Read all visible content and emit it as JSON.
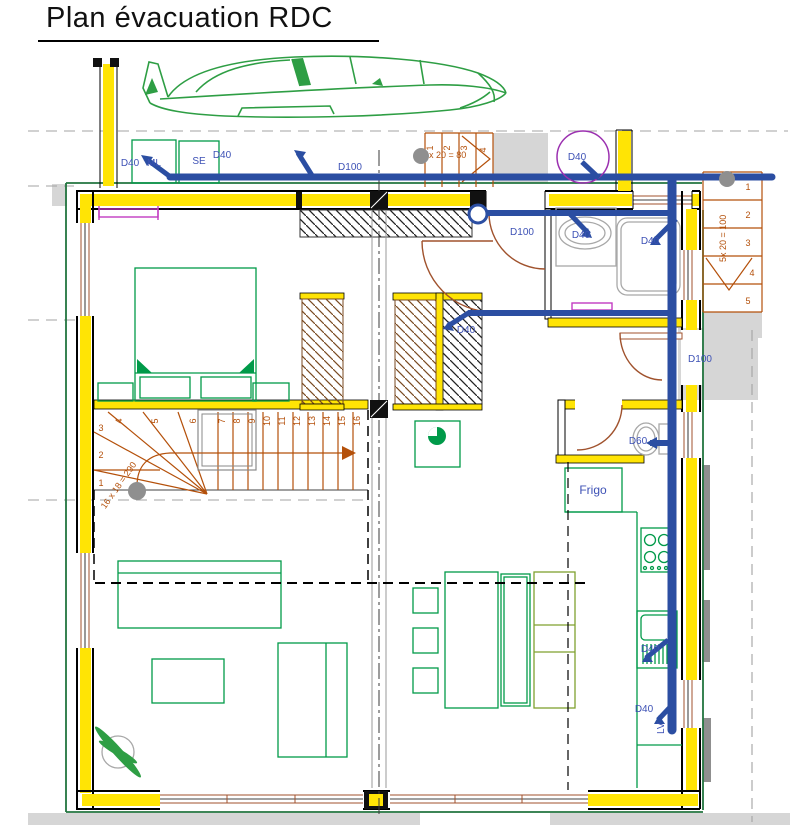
{
  "title": "Plan évacuation RDC",
  "colors": {
    "pipe_blue": "#2B4EA2",
    "label_blue": "#3D51B5",
    "insulation_yellow": "#FFE405",
    "furniture_green": "#009A49",
    "banquette_olive": "#7FA12F",
    "boundary_green": "#22753F",
    "stair_orange": "#B4500A",
    "door_brown": "#A0522D",
    "accent_magenta": "#C23BC2",
    "vent_purple": "#9B30B0",
    "paving_gray": "#D6D6D6",
    "fixture_gray": "#A8A8A8",
    "car_green": "#2E9E44"
  },
  "pipe_labels": {
    "washer_diam": "D40",
    "washer_name": "ML",
    "dryer_name": "SE",
    "dryer_diam": "D40",
    "main_collector": "D100",
    "roof_vent": "D40",
    "hall_branch": "D100",
    "basin": "D40",
    "shower": "D40",
    "closet_duct": "D40",
    "exterior_stack": "D100",
    "wc": "D60",
    "kitchen_sink": "D40",
    "dishwasher_diam": "D40",
    "dishwasher_name": "LV"
  },
  "kitchen": {
    "fridge": "Frigo"
  },
  "interior_stairs": {
    "formula": "16 x 18 = 290",
    "numbers": [
      "1",
      "2",
      "3",
      "4",
      "5",
      "6",
      "7",
      "8",
      "9",
      "10",
      "11",
      "12",
      "13",
      "14",
      "15",
      "16"
    ]
  },
  "entry_stairs": {
    "formula": "4x 20 = 80",
    "numbers": [
      "1",
      "2",
      "3",
      "4"
    ]
  },
  "side_stairs": {
    "formula": "5x 20 = 100",
    "numbers": [
      "1",
      "2",
      "3",
      "4",
      "5"
    ]
  }
}
